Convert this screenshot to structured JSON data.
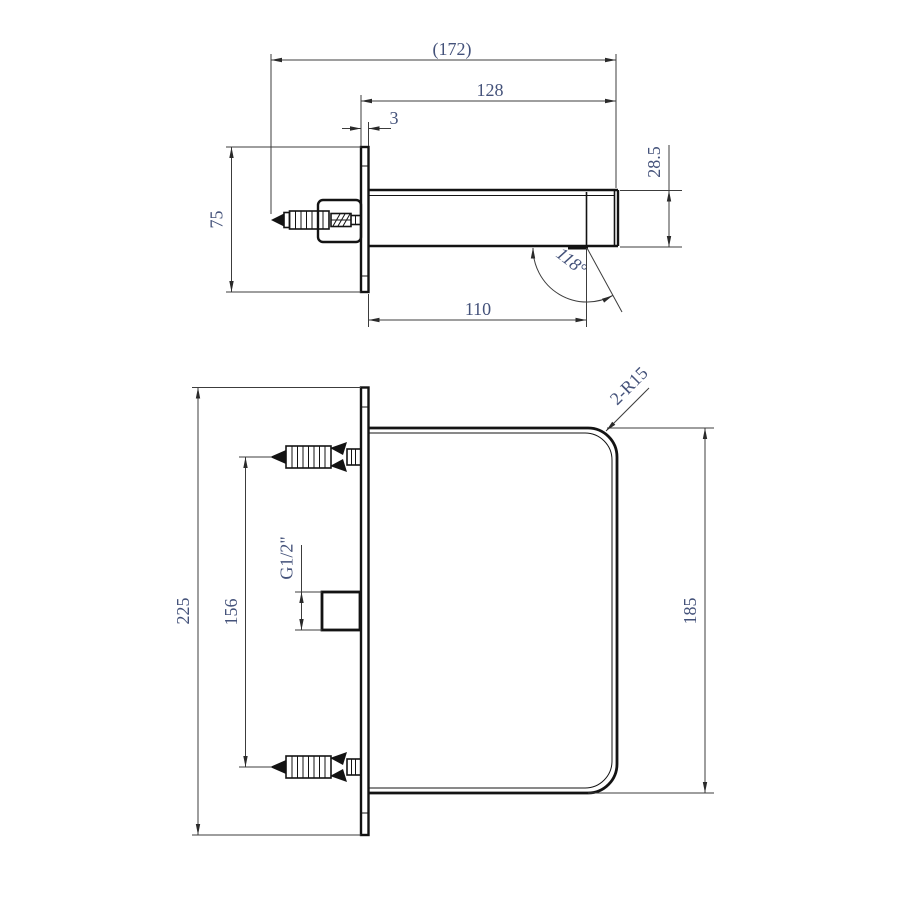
{
  "drawing": {
    "type": "technical-2d-drawing",
    "subject": "wall-mounted-spout",
    "colors": {
      "background": "#ffffff",
      "object_line": "#131313",
      "dimension_line": "#3c3c3c",
      "dimension_text": "#44527a"
    },
    "side_view": {
      "dims": {
        "overall_depth": "(172)",
        "spout_projection": "128",
        "plate_thickness": "3",
        "plate_height": "75",
        "spout_end_height": "28.5",
        "outlet_angle": "118°",
        "outlet_distance": "110"
      }
    },
    "plan_view": {
      "dims": {
        "plate_width": "225",
        "anchor_spacing": "156",
        "inlet_thread": "G1/2\"",
        "body_width": "185",
        "corner_radius": "2-R15"
      }
    }
  }
}
